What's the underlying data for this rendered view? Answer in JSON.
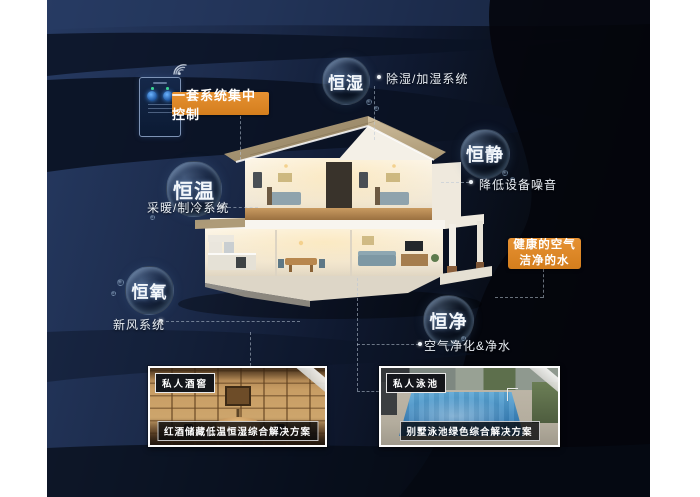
{
  "control": {
    "badge": "一套系统集中控制"
  },
  "features": [
    {
      "key": "humidity",
      "bubble": "恒湿",
      "system": "除湿/加湿系统"
    },
    {
      "key": "quiet",
      "bubble": "恒静",
      "system": "降低设备噪音"
    },
    {
      "key": "temperature",
      "bubble": "恒温",
      "system": "采暖/制冷系统"
    },
    {
      "key": "oxygen",
      "bubble": "恒氧",
      "system": "新风系统"
    },
    {
      "key": "purity",
      "bubble": "恒净",
      "system": "空气净化&净水"
    }
  ],
  "highlight": {
    "line1": "健康的空气",
    "line2": "洁净的水"
  },
  "cards": [
    {
      "tag": "私人酒窖",
      "caption": "红酒储藏低温恒湿综合解决方案"
    },
    {
      "tag": "私人泳池",
      "caption": "别墅泳池绿色综合解决方案"
    }
  ],
  "colors": {
    "accent_orange": "#dd8525",
    "background_navy": "#1b2a4a",
    "deep_black": "#05080e"
  }
}
